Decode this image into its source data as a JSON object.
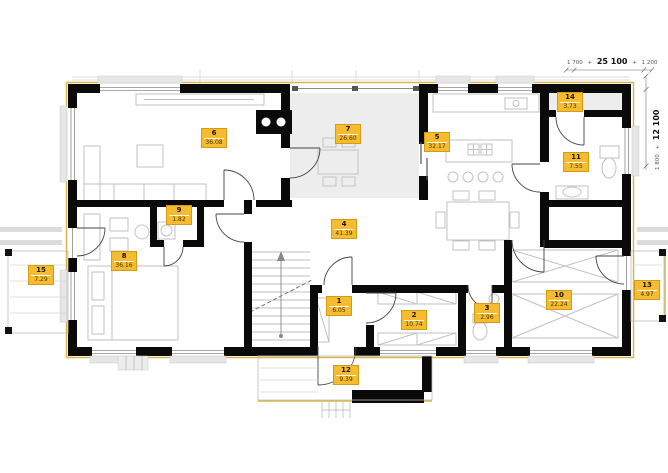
{
  "plan": {
    "dimensions": {
      "horizontal": {
        "left": "1 700",
        "plus1": "+",
        "main": "25 100",
        "plus2": "+",
        "right": "1 200"
      },
      "vertical": {
        "left": "1 800",
        "plus": "+",
        "main": "12 100"
      }
    },
    "rooms": [
      {
        "id": "1",
        "area": "6.05"
      },
      {
        "id": "2",
        "area": "10.74"
      },
      {
        "id": "3",
        "area": "2.96"
      },
      {
        "id": "4",
        "area": "41.39"
      },
      {
        "id": "5",
        "area": "32.17"
      },
      {
        "id": "6",
        "area": "36.08"
      },
      {
        "id": "7",
        "area": "26.60"
      },
      {
        "id": "8",
        "area": "36.16"
      },
      {
        "id": "9",
        "area": "1.82"
      },
      {
        "id": "10",
        "area": "22.24"
      },
      {
        "id": "11",
        "area": "7.55"
      },
      {
        "id": "12",
        "area": "9.39"
      },
      {
        "id": "13",
        "area": "4.97"
      },
      {
        "id": "14",
        "area": "3.73"
      },
      {
        "id": "15",
        "area": "7.29"
      }
    ],
    "colors": {
      "label_bg": "#f4bc2e",
      "label_border": "#d49b16",
      "wall": "#0a0a0a",
      "insulation_yellow": "#d8b540",
      "furniture_line": "#c2c2c2",
      "terrace_fill": "#ededed"
    }
  }
}
